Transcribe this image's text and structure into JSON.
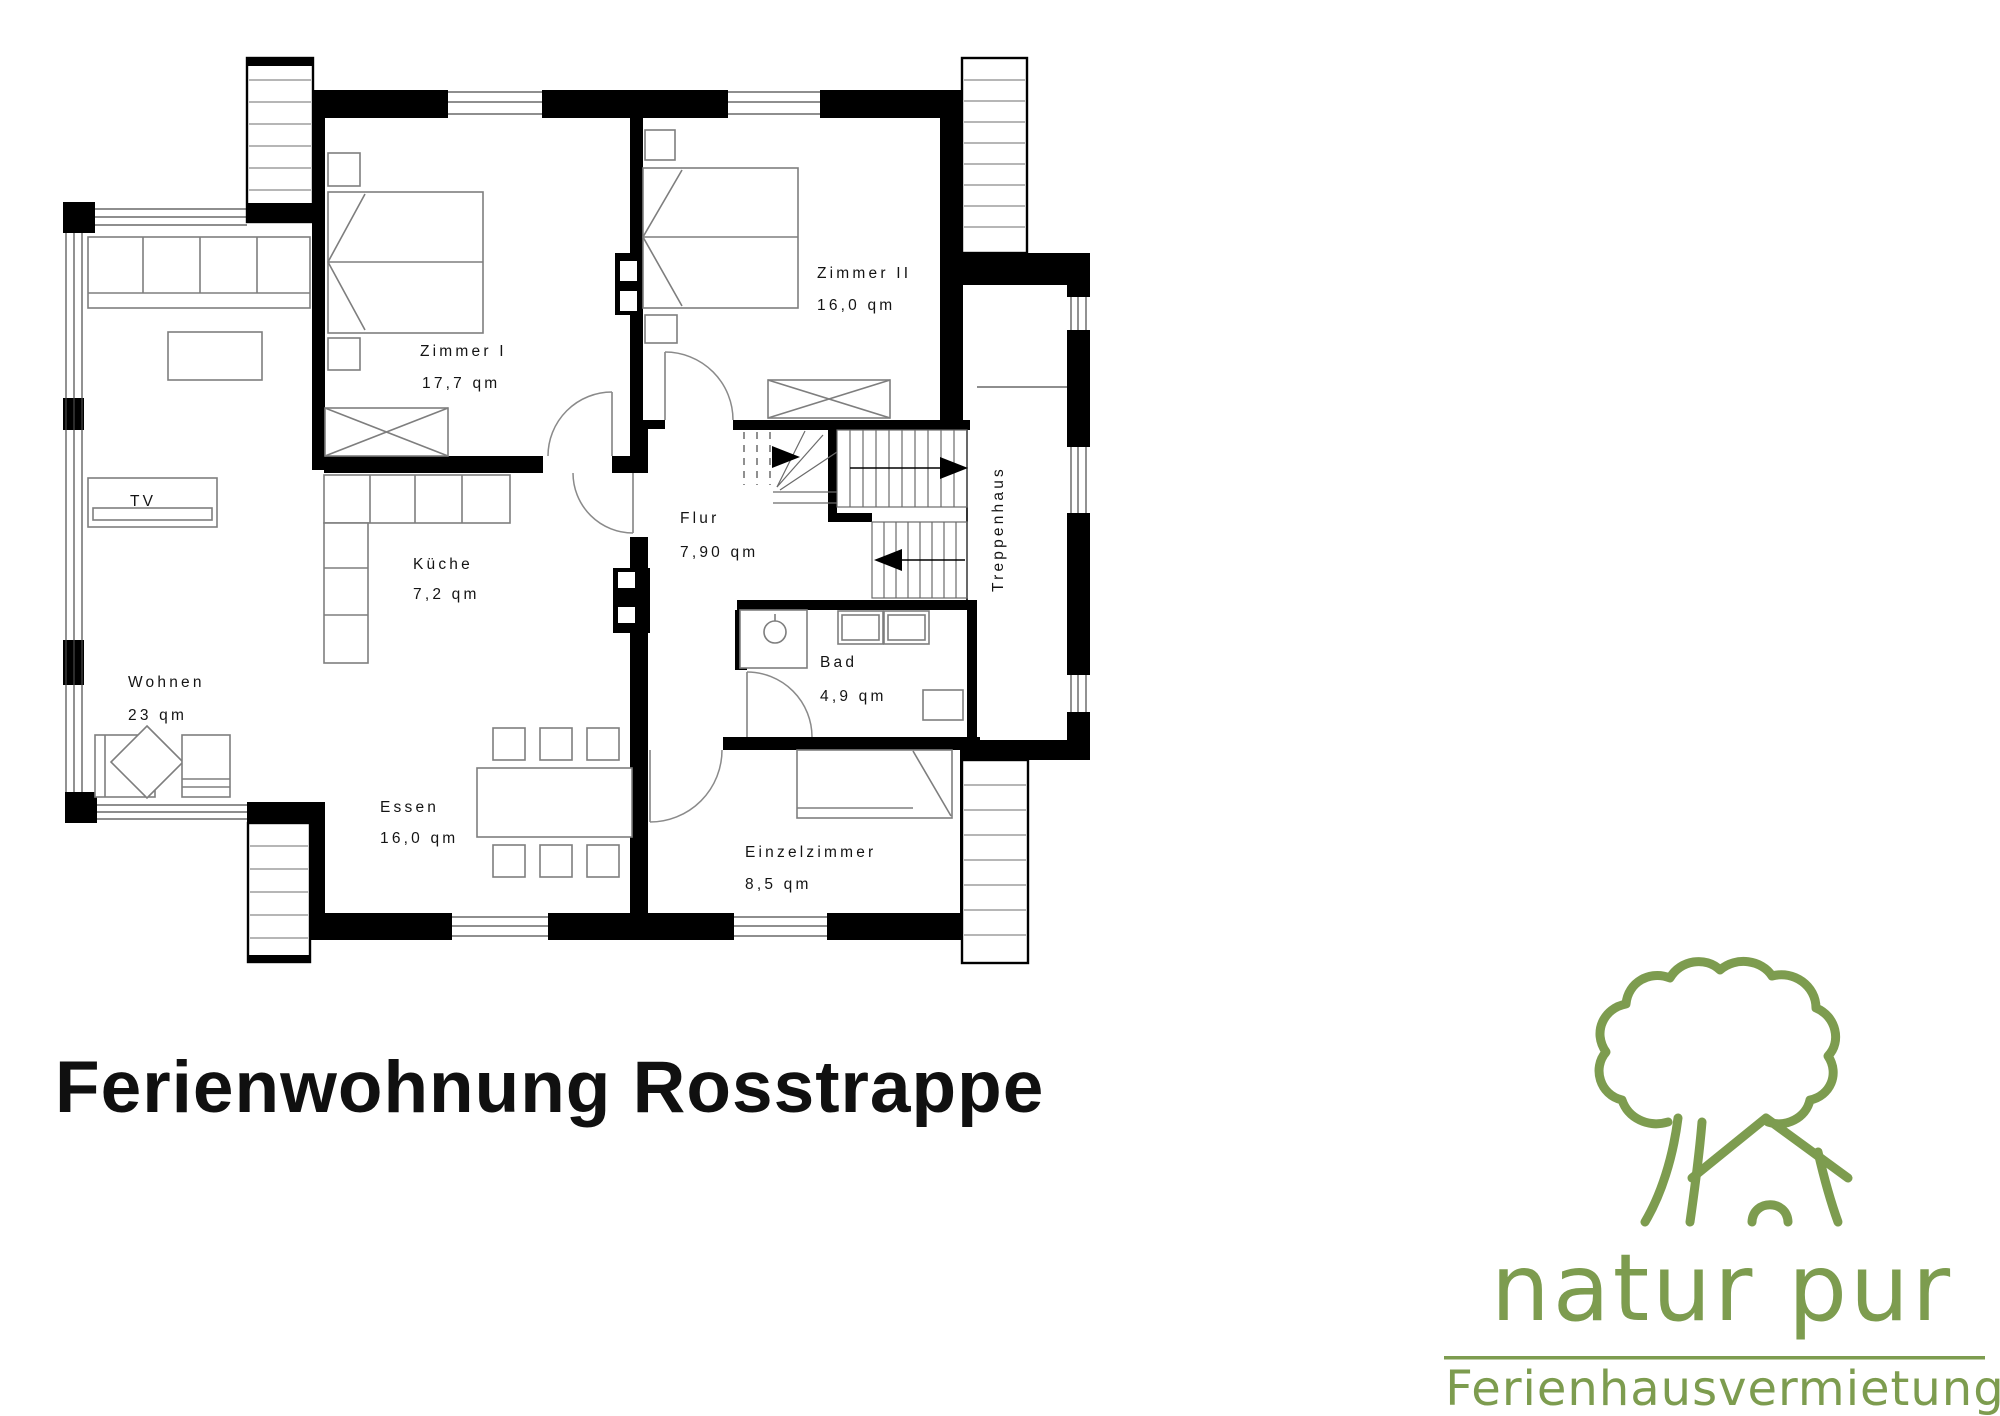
{
  "title": "Ferienwohnung Rosstrappe",
  "colors": {
    "walls": "#000000",
    "furniture": "#7e7e7e",
    "logo_green": "#7d9c4f"
  },
  "rooms": {
    "zimmer1": {
      "label": "Zimmer I",
      "area": "17,7 qm"
    },
    "zimmer2": {
      "label": "Zimmer II",
      "area": "16,0 qm"
    },
    "flur": {
      "label": "Flur",
      "area": "7,90 qm"
    },
    "kueche": {
      "label": "Küche",
      "area": "7,2 qm"
    },
    "wohnen": {
      "label": "Wohnen",
      "area": "23 qm"
    },
    "essen": {
      "label": "Essen",
      "area": "16,0 qm"
    },
    "bad": {
      "label": "Bad",
      "area": "4,9 qm"
    },
    "einzelzimmer": {
      "label": "Einzelzimmer",
      "area": "8,5 qm"
    },
    "treppenhaus": {
      "label": "Treppenhaus"
    },
    "tv": {
      "label": "TV"
    }
  },
  "logo": {
    "brand": "natur pur",
    "subtitle": "Ferienhausvermietung"
  }
}
